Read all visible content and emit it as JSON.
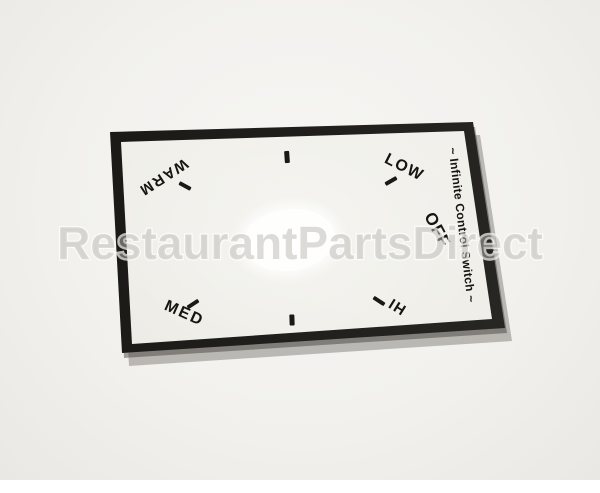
{
  "image_type": "product-photo",
  "watermark": {
    "text": "RestaurantPartsDirect"
  },
  "decal": {
    "title": "~ Infinite Control Switch ~",
    "labels": {
      "warm": "WARM",
      "low": "LOW",
      "off": "OFF",
      "med": "MED",
      "hi": "HI"
    },
    "tick_count": 6
  },
  "colors": {
    "background": "#f2f1ee",
    "decal_border": "#1e1d1a",
    "decal_face": "#efeee8",
    "hole": "#fefefc",
    "text": "#16150f",
    "watermark_fill": "#bab8b2",
    "watermark_outline": "#ffffff"
  }
}
